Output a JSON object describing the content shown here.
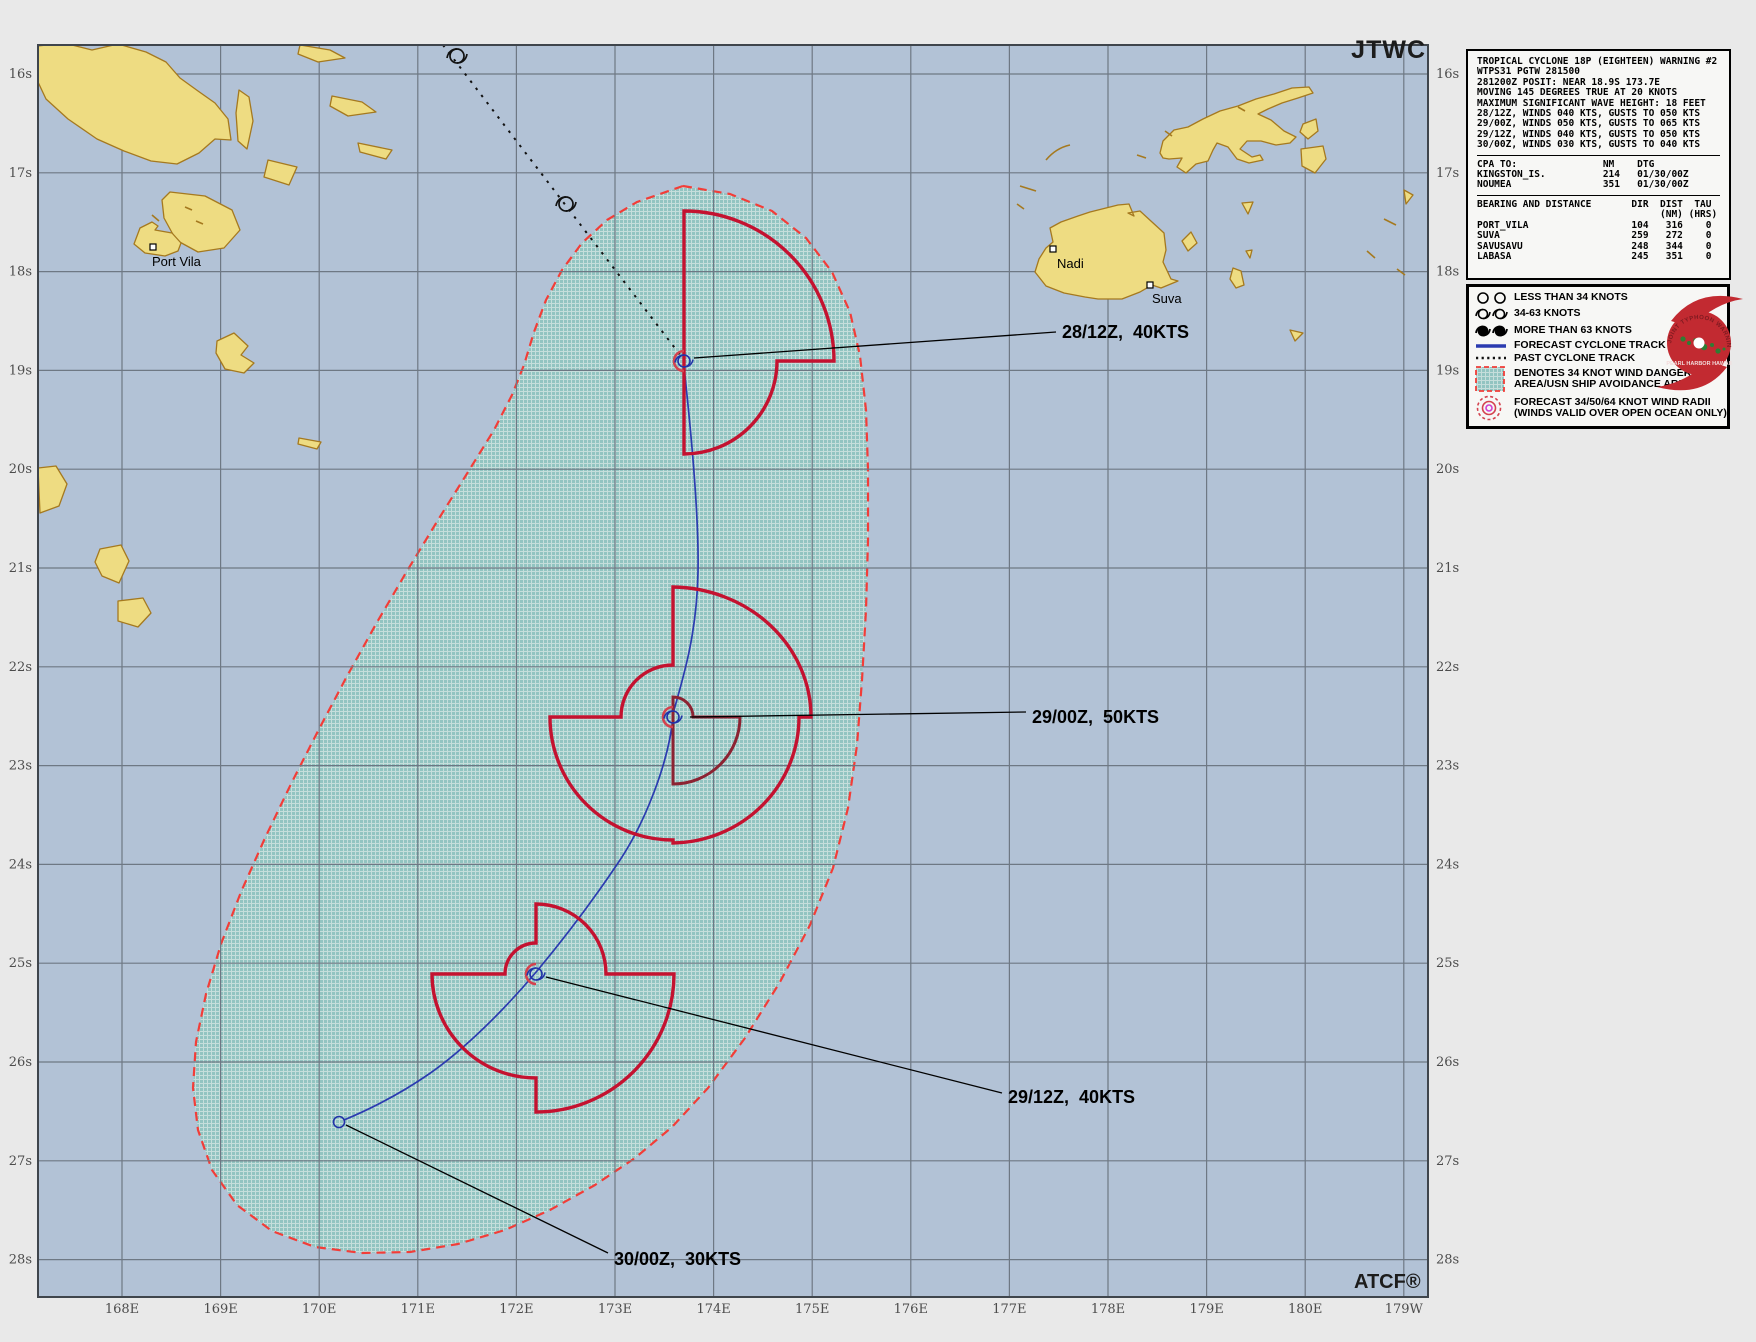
{
  "window": {
    "agency_label": "JTWC",
    "software_label": "ATCF®"
  },
  "warning_box": {
    "header_lines": "TROPICAL CYCLONE 18P (EIGHTEEN) WARNING #2\nWTPS31 PGTW 281500\n281200Z POSIT: NEAR 18.9S 173.7E\nMOVING 145 DEGREES TRUE AT 20 KNOTS\nMAXIMUM SIGNIFICANT WAVE HEIGHT: 18 FEET\n28/12Z, WINDS 040 KTS, GUSTS TO 050 KTS\n29/00Z, WINDS 050 KTS, GUSTS TO 065 KTS\n29/12Z, WINDS 040 KTS, GUSTS TO 050 KTS\n30/00Z, WINDS 030 KTS, GUSTS TO 040 KTS",
    "cpa_lines": "CPA TO:               NM    DTG\nKINGSTON_IS.          214   01/30/00Z\nNOUMEA                351   01/30/00Z",
    "bearing_lines": "BEARING AND DISTANCE       DIR  DIST  TAU\n                                (NM) (HRS)\nPORT_VILA                  104   316    0\nSUVA                       259   272    0\nSAVUSAVU                   248   344    0\nLABASA                     245   351    0"
  },
  "legend": {
    "rows": [
      {
        "label": "LESS THAN 34 KNOTS"
      },
      {
        "label": "34-63 KNOTS"
      },
      {
        "label": "MORE THAN 63 KNOTS"
      },
      {
        "label": "FORECAST CYCLONE TRACK"
      },
      {
        "label": "PAST CYCLONE TRACK"
      },
      {
        "label": "DENOTES 34 KNOT WIND DANGER\nAREA/USN SHIP AVOIDANCE AREA"
      },
      {
        "label": "FORECAST 34/50/64 KNOT WIND RADII\n(WINDS VALID OVER OPEN OCEAN ONLY)"
      }
    ],
    "seal": {
      "arc_text": "JOINT TYPHOON WARNING CENTER",
      "center_text": "PEARL HARBOR\nHAWAII"
    }
  },
  "map": {
    "axis": {
      "lat": [
        "16s",
        "17s",
        "18s",
        "19s",
        "20s",
        "21s",
        "22s",
        "23s",
        "24s",
        "25s",
        "26s",
        "27s",
        "28s"
      ],
      "lon": [
        "168E",
        "169E",
        "170E",
        "171E",
        "172E",
        "173E",
        "174E",
        "175E",
        "176E",
        "177E",
        "178E",
        "179E",
        "180E",
        "179W"
      ]
    },
    "cities": [
      {
        "name": "Port Vila"
      },
      {
        "name": "Nadi"
      },
      {
        "name": "Suva"
      }
    ],
    "points": [
      {
        "time": "28/12Z",
        "winds_kts": 40,
        "label": "28/12Z,  40KTS"
      },
      {
        "time": "29/00Z",
        "winds_kts": 50,
        "label": "29/00Z,  50KTS"
      },
      {
        "time": "29/12Z",
        "winds_kts": 40,
        "label": "29/12Z,  40KTS"
      },
      {
        "time": "30/00Z",
        "winds_kts": 30,
        "label": "30/00Z,  30KTS"
      }
    ],
    "colors": {
      "ocean": "#b2c2d6",
      "land": "#eedc82",
      "land_outline": "#a5791f",
      "danger_border_red": "#f23d38",
      "danger_fill_teal": "#92c4c1",
      "wind_radii_34kt": "#c41230",
      "wind_radii_50kt": "#8c2332",
      "forecast_track_blue": "#2b3bb0",
      "past_track_black": "#111111"
    }
  }
}
